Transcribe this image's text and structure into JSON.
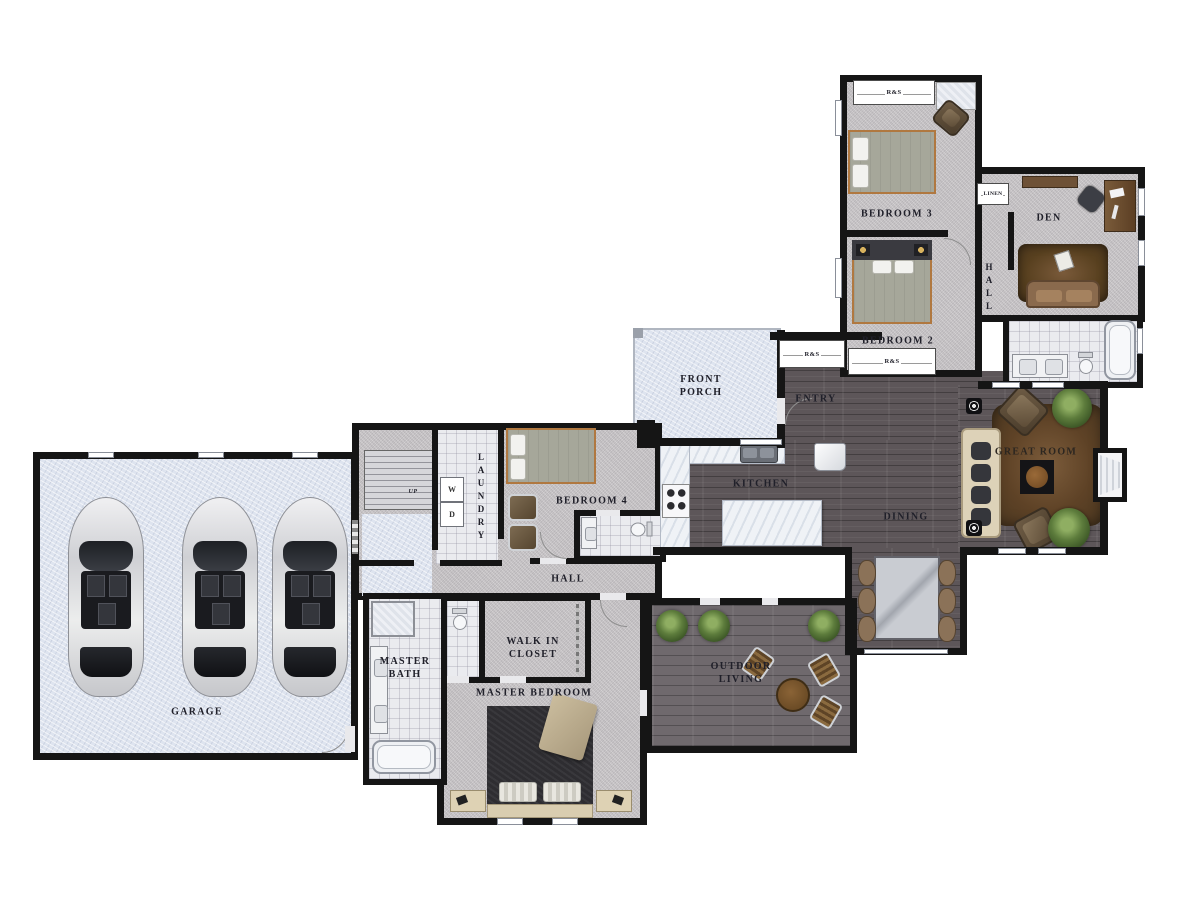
{
  "plan_type": "residential-floor-plan",
  "rooms": {
    "garage": {
      "label": "GARAGE",
      "car_count": 3
    },
    "master_bath": {
      "label": "MASTER BATH"
    },
    "walk_in_closet": {
      "label": "WALK IN CLOSET"
    },
    "master_bedroom": {
      "label": "MASTER BEDROOM"
    },
    "bedroom4": {
      "label": "BEDROOM 4"
    },
    "hall_main": {
      "label": "HALL"
    },
    "laundry": {
      "label": "LAUNDRY"
    },
    "front_porch": {
      "label": "FRONT PORCH"
    },
    "entry": {
      "label": "ENTRY"
    },
    "kitchen": {
      "label": "KITCHEN"
    },
    "dining": {
      "label": "DINING"
    },
    "great_room": {
      "label": "GREAT ROOM"
    },
    "outdoor_living": {
      "label": "OUTDOOR LIVING"
    },
    "bedroom2": {
      "label": "BEDROOM 2"
    },
    "bedroom3": {
      "label": "BEDROOM 3"
    },
    "den": {
      "label": "DEN"
    },
    "hall_bedrooms": {
      "label": "HALL"
    },
    "linen": {
      "label": "LINEN"
    }
  },
  "annotations": {
    "stairs_up": "UP",
    "washer": "W",
    "dryer": "D",
    "closet_rod_shelf": "R&S"
  },
  "palette": {
    "wall": "#151515",
    "carpet": "#c8c5c7",
    "wood_floor": "#5d5659",
    "outdoor_wood": "#6f696d",
    "concrete": "#dee4ef",
    "tile": "#eaebef",
    "bed_frame_accent": "#b07840",
    "rug_brown": "#6b4e33",
    "sofa_cream": "#ddd2b8"
  }
}
